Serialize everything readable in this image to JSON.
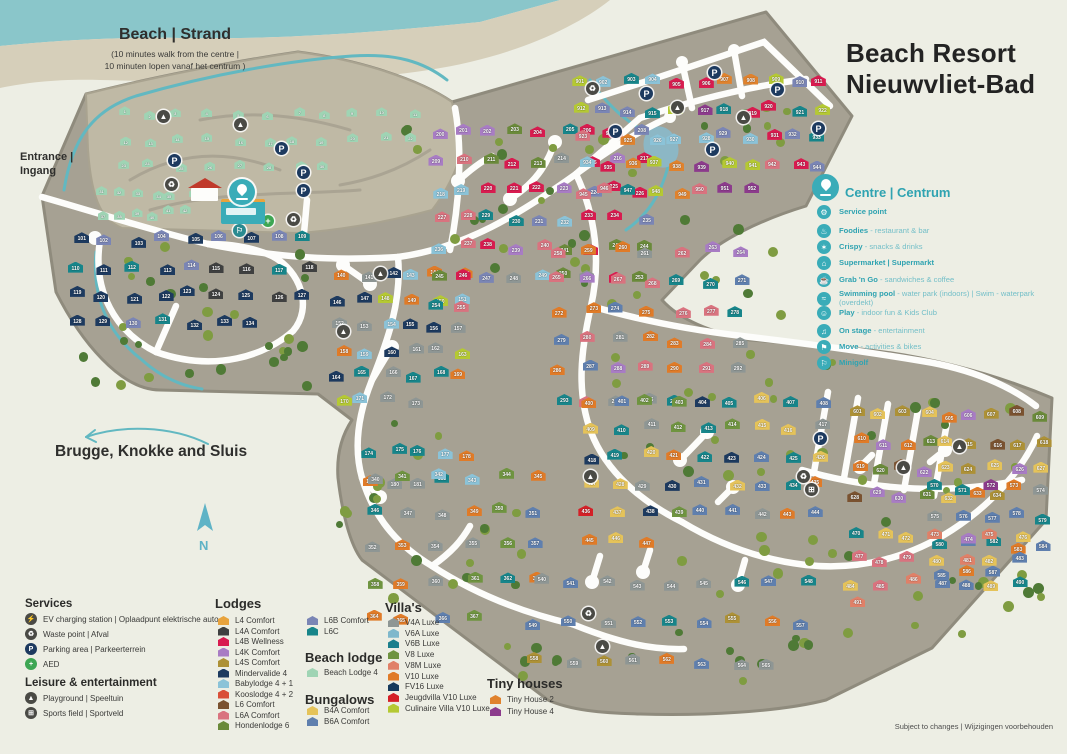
{
  "title": {
    "line1": "Beach Resort",
    "line2": "Nieuwvliet-Bad"
  },
  "beach": {
    "heading": "Beach | Strand",
    "sub1": "(10 minutes walk from the centre |",
    "sub2": "10 minuten lopen vanaf het centrum )"
  },
  "entrance": {
    "line1": "Entrance |",
    "line2": "Ingang"
  },
  "direction": {
    "text": "Brugge, Knokke and Sluis"
  },
  "compass": {
    "letter": "N"
  },
  "footnote": "Subject to changes | Wijzigingen voorbehouden",
  "accent": "#3aacb8",
  "centre_legend": {
    "heading": "Centre | Centrum",
    "items": [
      {
        "icon": "service-point-icon",
        "glyph": "⚙",
        "name": "Service point",
        "desc": ""
      },
      {
        "icon": "foodies-icon",
        "glyph": "♨",
        "name": "Foodies",
        "desc": "- restaurant & bar"
      },
      {
        "icon": "crispy-icon",
        "glyph": "✶",
        "name": "Crispy",
        "desc": "- snacks & drinks"
      },
      {
        "icon": "supermarket-icon",
        "glyph": "⌂",
        "name": "Supermarket | Supermarkt",
        "desc": ""
      },
      {
        "icon": "grab-n-go-icon",
        "glyph": "☕",
        "name": "Grab 'n Go",
        "desc": "- sandwiches & coffee"
      },
      {
        "icon": "swimming-pool-icon",
        "glyph": "≈",
        "name": "Swimming pool",
        "desc": "- water park (indoors) | Swim - waterpark (overdekt)"
      },
      {
        "icon": "play-icon",
        "glyph": "☺",
        "name": "Play",
        "desc": "- indoor fun & Kids Club"
      },
      {
        "icon": "on-stage-icon",
        "glyph": "♫",
        "name": "On stage",
        "desc": "- entertainment"
      },
      {
        "icon": "move-icon",
        "glyph": "⚑",
        "name": "Move",
        "desc": "- activities & bikes"
      },
      {
        "icon": "minigolf-icon",
        "glyph": "⚐",
        "name": "Minigolf",
        "desc": ""
      }
    ]
  },
  "services": {
    "heading": "Services",
    "items": [
      {
        "icon": "ev-charging-icon",
        "glyph": "⚡",
        "bg": "#4a4a45",
        "label": "EV charging station | Oplaadpunt elektrische auto"
      },
      {
        "icon": "waste-point-icon",
        "glyph": "♻",
        "bg": "#4a4a45",
        "label": "Waste point | Afval"
      },
      {
        "icon": "parking-icon",
        "glyph": "P",
        "bg": "#1d3a5f",
        "label": "Parking area | Parkeerterrein"
      },
      {
        "icon": "aed-icon",
        "glyph": "+",
        "bg": "#3da653",
        "label": "AED"
      }
    ]
  },
  "leisure": {
    "heading": "Leisure & entertainment",
    "items": [
      {
        "icon": "playground-icon",
        "glyph": "▲",
        "bg": "#4a4a45",
        "label": "Playground | Speeltuin"
      },
      {
        "icon": "sports-field-icon",
        "glyph": "⊞",
        "bg": "#4a4a45",
        "label": "Sports field | Sportveld"
      }
    ]
  },
  "lodges": {
    "heading": "Lodges",
    "col1": [
      {
        "label": "L4 Comfort",
        "color": "#e8a33d"
      },
      {
        "label": "L4A Comfort",
        "color": "#3f4040"
      },
      {
        "label": "L4B Wellness",
        "color": "#d81b4f"
      },
      {
        "label": "L4K Comfort",
        "color": "#a87cc4"
      },
      {
        "label": "L4S Comfort",
        "color": "#ad9136"
      },
      {
        "label": "Mindervalide 4",
        "color": "#1d3a5f"
      },
      {
        "label": "Babylodge 4 + 1",
        "color": "#8bc3d8"
      },
      {
        "label": "Kooslodge 4 + 2",
        "color": "#d94f38"
      },
      {
        "label": "L6 Comfort",
        "color": "#7a5230"
      },
      {
        "label": "L6A Comfort",
        "color": "#d9737f"
      },
      {
        "label": "Hondenlodge 6",
        "color": "#6a8a3a"
      }
    ],
    "col2": [
      {
        "label": "L6B Comfort",
        "color": "#7a85b5"
      },
      {
        "label": "L6C",
        "color": "#17858a"
      }
    ]
  },
  "beach_lodge": {
    "heading": "Beach lodge",
    "items": [
      {
        "label": "Beach Lodge 4",
        "color": "#9fd4b4"
      }
    ]
  },
  "bungalows": {
    "heading": "Bungalows",
    "items": [
      {
        "label": "B4A Comfort",
        "color": "#e5c35a"
      },
      {
        "label": "B6A Comfort",
        "color": "#5f7fae"
      }
    ]
  },
  "villas": {
    "heading": "Villa's",
    "items": [
      {
        "label": "V4A Luxe",
        "color": "#8e9694"
      },
      {
        "label": "V6A Luxe",
        "color": "#7fb8cc"
      },
      {
        "label": "V6B Luxe",
        "color": "#1b7f8c"
      },
      {
        "label": "V8 Luxe",
        "color": "#6f9440"
      },
      {
        "label": "V8M Luxe",
        "color": "#e08068"
      },
      {
        "label": "V10 Luxe",
        "color": "#e07b28"
      },
      {
        "label": "FV16 Luxe",
        "color": "#173a5c"
      },
      {
        "label": "Jeugdvilla V10 Luxe",
        "color": "#d42027"
      },
      {
        "label": "Culinaire Villa V10 Luxe",
        "color": "#b5c933"
      }
    ]
  },
  "tiny_houses": {
    "heading": "Tiny houses",
    "items": [
      {
        "label": "Tiny House 2",
        "color": "#e0822d"
      },
      {
        "label": "Tiny House 4",
        "color": "#8c3b8c"
      }
    ]
  },
  "map": {
    "palette": {
      "beach": "#9fd4b4",
      "navy": "#1d3a5f",
      "slate": "#7a85b5",
      "teal": "#17858a",
      "darkgray": "#3f4040",
      "lightblue": "#8bc3d8",
      "orange": "#e07b28",
      "gray": "#8e9694",
      "lime": "#b5c933",
      "pink": "#d9737f",
      "lilac": "#a87cc4",
      "dgreen": "#6a8a3a",
      "crimson": "#d81b4f",
      "blue": "#5f7fae",
      "yellow": "#e5c35a",
      "red": "#d42027",
      "green": "#6f9440",
      "brown": "#7a5230",
      "olive": "#ad9136",
      "purple": "#8c3b8c",
      "torange": "#e0822d",
      "salmon": "#e08068"
    },
    "tree_colors": [
      "#4f7a36",
      "#7f9c41"
    ],
    "clusters": [
      {
        "x": 108,
        "y": 100,
        "w": 322,
        "h": 80,
        "count": 30,
        "start": 1,
        "small": true,
        "colors": [
          "beach"
        ]
      },
      {
        "x": 95,
        "y": 182,
        "w": 105,
        "h": 42,
        "count": 12,
        "start": 31,
        "small": true,
        "colors": [
          "beach"
        ]
      },
      {
        "x": 62,
        "y": 224,
        "w": 258,
        "h": 112,
        "count": 34,
        "start": 101,
        "colors": [
          "navy",
          "navy",
          "navy",
          "slate",
          "teal",
          "darkgray"
        ]
      },
      {
        "x": 328,
        "y": 262,
        "w": 145,
        "h": 150,
        "count": 34,
        "start": 140,
        "colors": [
          "orange",
          "teal",
          "gray",
          "lightblue",
          "lime",
          "navy"
        ]
      },
      {
        "x": 360,
        "y": 438,
        "w": 120,
        "h": 55,
        "count": 9,
        "start": 174,
        "colors": [
          "orange",
          "teal",
          "lightblue",
          "gray"
        ]
      },
      {
        "x": 425,
        "y": 118,
        "w": 230,
        "h": 198,
        "count": 56,
        "start": 200,
        "colors": [
          "pink",
          "lilac",
          "slate",
          "dgreen",
          "teal",
          "crimson",
          "gray",
          "lightblue"
        ]
      },
      {
        "x": 545,
        "y": 235,
        "w": 208,
        "h": 178,
        "count": 40,
        "start": 258,
        "colors": [
          "teal",
          "orange",
          "pink",
          "gray",
          "blue",
          "lilac"
        ]
      },
      {
        "x": 355,
        "y": 458,
        "w": 198,
        "h": 175,
        "count": 28,
        "start": 340,
        "colors": [
          "teal",
          "blue",
          "orange",
          "green",
          "gray",
          "lightblue"
        ]
      },
      {
        "x": 575,
        "y": 385,
        "w": 258,
        "h": 168,
        "count": 48,
        "start": 400,
        "colors": [
          "blue",
          "yellow",
          "teal",
          "orange",
          "red",
          "gray",
          "green",
          "navy"
        ]
      },
      {
        "x": 520,
        "y": 562,
        "w": 300,
        "h": 118,
        "count": 26,
        "start": 540,
        "colors": [
          "teal",
          "orange",
          "blue",
          "gray",
          "olive"
        ]
      },
      {
        "x": 845,
        "y": 400,
        "w": 208,
        "h": 108,
        "count": 34,
        "start": 601,
        "colors": [
          "orange",
          "brown",
          "olive",
          "lilac",
          "yellow",
          "dgreen"
        ]
      },
      {
        "x": 925,
        "y": 472,
        "w": 128,
        "h": 115,
        "count": 18,
        "start": 570,
        "colors": [
          "teal",
          "blue",
          "orange",
          "purple",
          "gray"
        ]
      },
      {
        "x": 840,
        "y": 522,
        "w": 195,
        "h": 95,
        "count": 22,
        "start": 470,
        "colors": [
          "pink",
          "blue",
          "teal",
          "yellow",
          "lilac",
          "salmon"
        ]
      },
      {
        "x": 570,
        "y": 68,
        "w": 262,
        "h": 135,
        "count": 52,
        "start": 901,
        "colors": [
          "pink",
          "purple",
          "torange",
          "teal",
          "lime",
          "lightblue",
          "slate",
          "crimson"
        ]
      }
    ],
    "tree_clusters": [
      [
        60,
        330,
        250,
        55,
        13
      ],
      [
        330,
        415,
        110,
        110,
        9
      ],
      [
        480,
        628,
        320,
        58,
        13
      ],
      [
        840,
        545,
        200,
        85,
        11
      ],
      [
        560,
        195,
        240,
        115,
        15
      ],
      [
        360,
        480,
        160,
        115,
        11
      ],
      [
        620,
        92,
        200,
        105,
        9
      ],
      [
        90,
        240,
        230,
        115,
        15
      ],
      [
        400,
        122,
        240,
        155,
        17
      ],
      [
        600,
        330,
        240,
        145,
        17
      ],
      [
        650,
        530,
        200,
        115,
        13
      ],
      [
        850,
        385,
        195,
        135,
        11
      ]
    ],
    "icons": {
      "parking": [
        [
          174,
          160
        ],
        [
          281,
          148
        ],
        [
          303,
          172
        ],
        [
          303,
          190
        ],
        [
          646,
          93
        ],
        [
          714,
          72
        ],
        [
          777,
          89
        ],
        [
          615,
          131
        ],
        [
          712,
          149
        ],
        [
          818,
          128
        ],
        [
          820,
          438
        ]
      ],
      "waste": [
        [
          171,
          184
        ],
        [
          293,
          219
        ],
        [
          592,
          88
        ],
        [
          803,
          476
        ],
        [
          588,
          613
        ]
      ],
      "playground": [
        [
          163,
          116
        ],
        [
          240,
          124
        ],
        [
          677,
          107
        ],
        [
          743,
          117
        ],
        [
          380,
          273
        ],
        [
          343,
          331
        ],
        [
          959,
          446
        ],
        [
          903,
          467
        ],
        [
          602,
          646
        ],
        [
          590,
          476
        ]
      ],
      "sports": [
        [
          811,
          489
        ]
      ],
      "aed": [
        [
          268,
          221
        ]
      ],
      "minigolf": [
        [
          239,
          230
        ]
      ]
    }
  }
}
